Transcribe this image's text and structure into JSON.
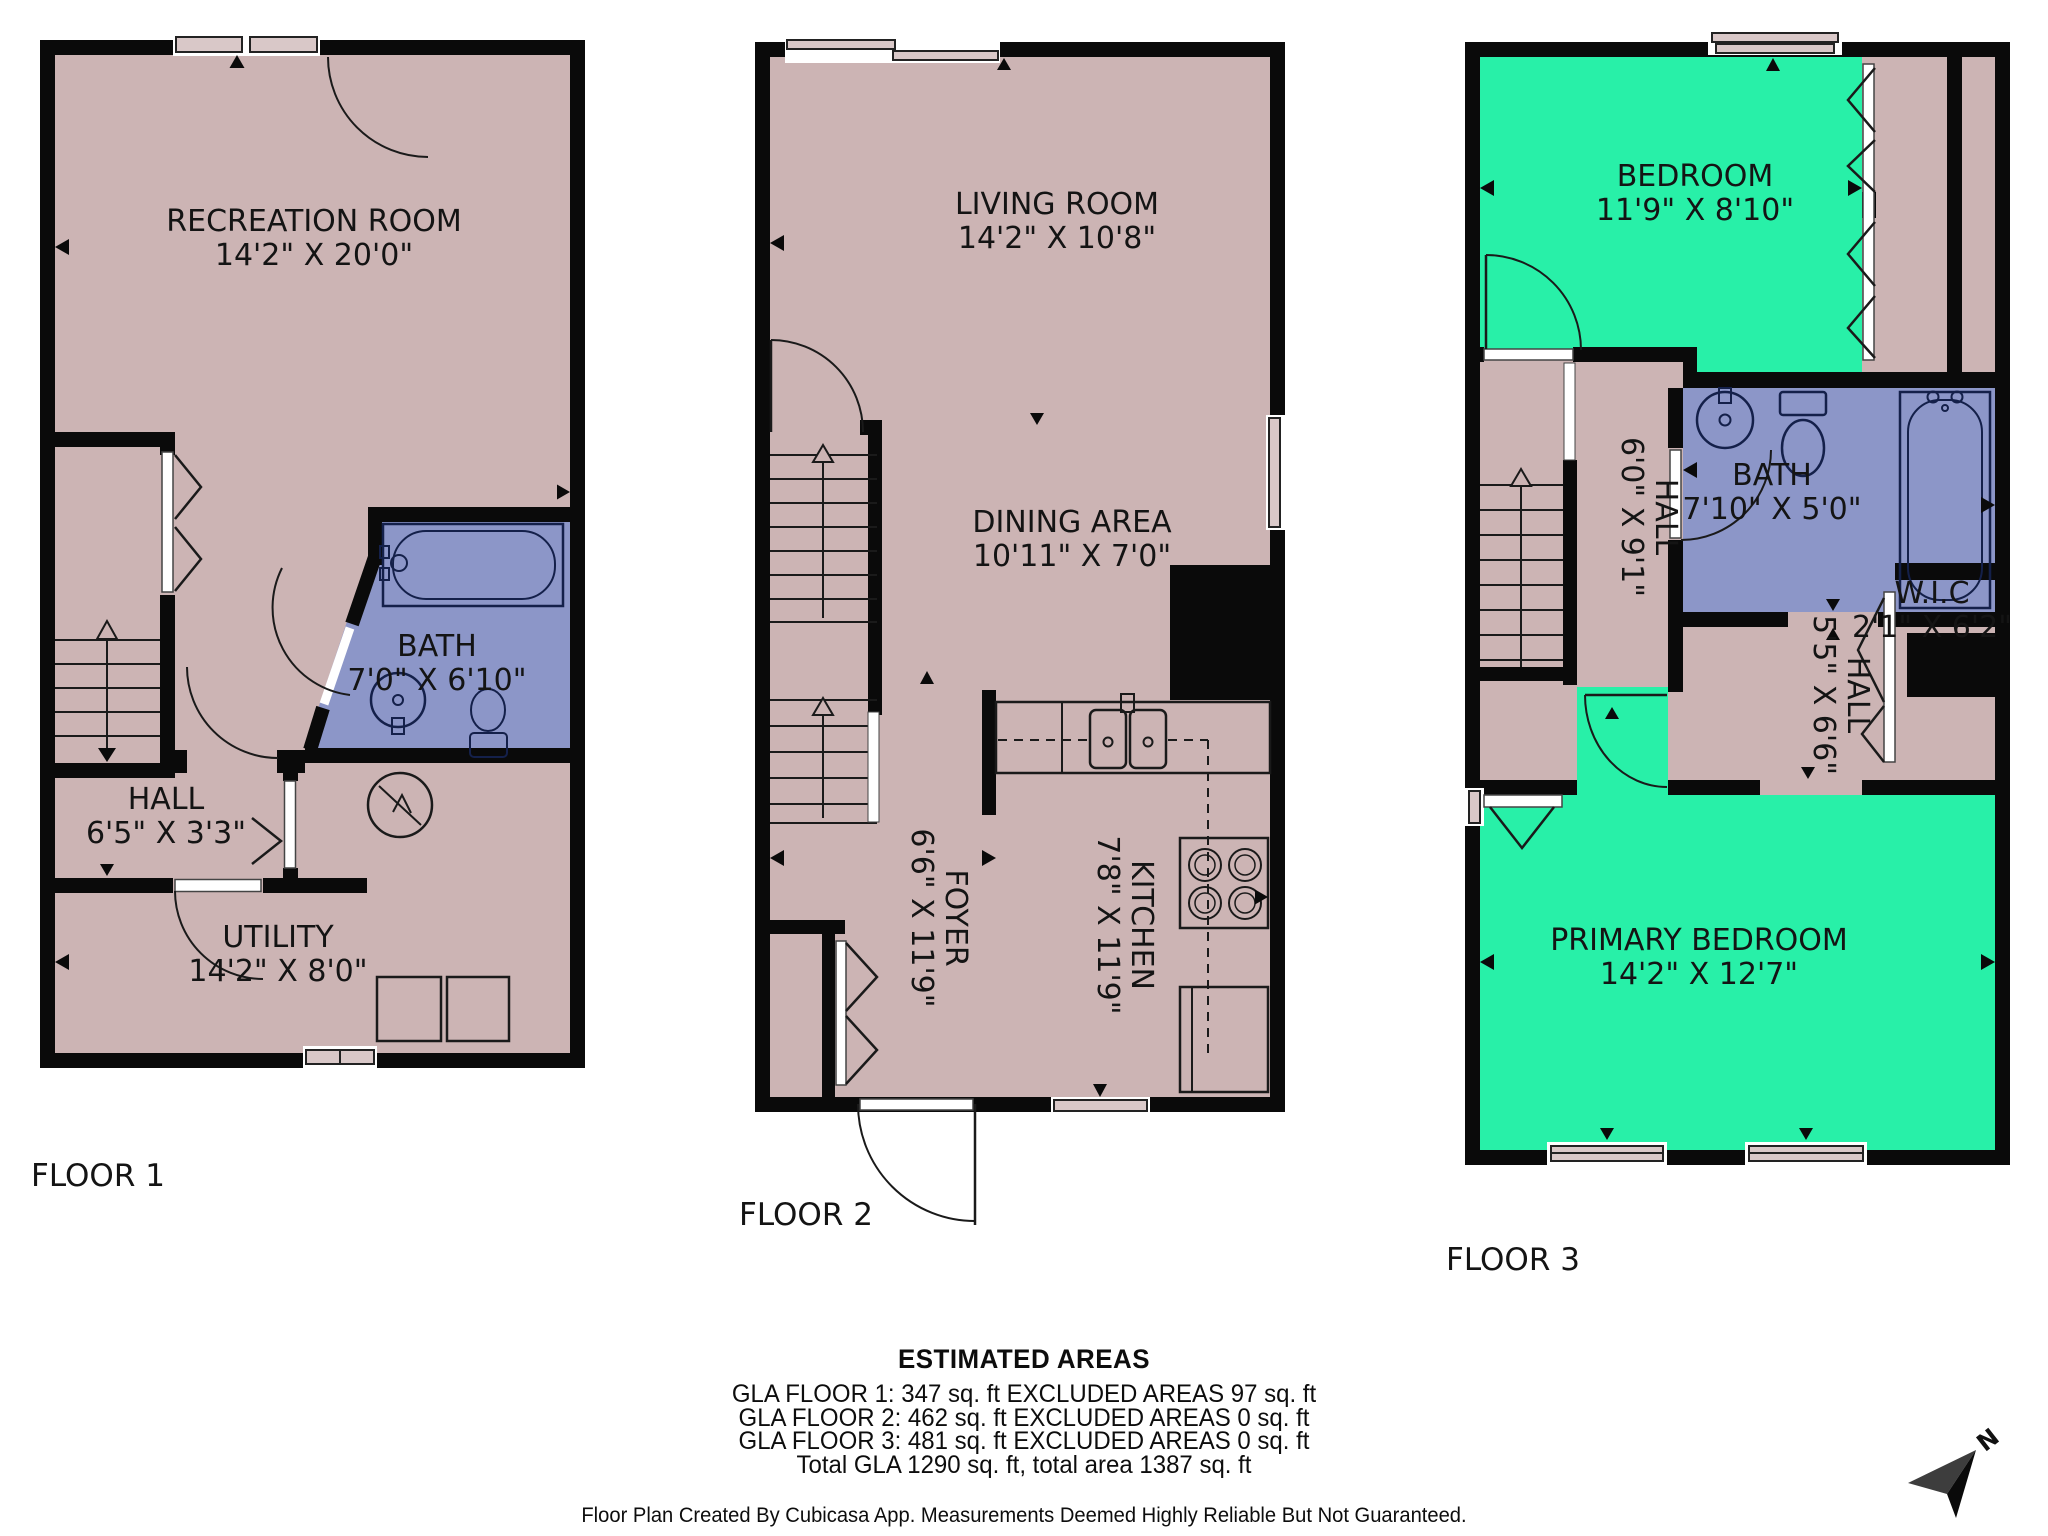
{
  "colors": {
    "floor": "#ccb4b4",
    "wet_room": "#8c96c8",
    "bedroom": "#28f0a8",
    "wall": "#0a0a0a",
    "background": "#ffffff"
  },
  "floors": [
    {
      "label": "FLOOR 1",
      "rooms": [
        {
          "name": "RECREATION ROOM",
          "dims": "14'2\" X 20'0\""
        },
        {
          "name": "BATH",
          "dims": "7'0\" X 6'10\""
        },
        {
          "name": "HALL",
          "dims": "6'5\" X 3'3\""
        },
        {
          "name": "UTILITY",
          "dims": "14'2\" X 8'0\""
        }
      ]
    },
    {
      "label": "FLOOR 2",
      "rooms": [
        {
          "name": "LIVING ROOM",
          "dims": "14'2\" X 10'8\""
        },
        {
          "name": "DINING AREA",
          "dims": "10'11\" X 7'0\""
        },
        {
          "name": "FOYER",
          "dims": "6'6\" X 11'9\""
        },
        {
          "name": "KITCHEN",
          "dims": "7'8\" X 11'9\""
        }
      ]
    },
    {
      "label": "FLOOR 3",
      "rooms": [
        {
          "name": "BEDROOM",
          "dims": "11'9\" X 8'10\""
        },
        {
          "name": "BATH",
          "dims": "7'10\" X 5'0\""
        },
        {
          "name": "HALL",
          "dims": "6'0\" X 9'1\""
        },
        {
          "name": "W.I.C",
          "dims": "2'1\" X 6'2\""
        },
        {
          "name": "HALL",
          "dims": "5'5\" X 6'6\""
        },
        {
          "name": "PRIMARY BEDROOM",
          "dims": "14'2\" X 12'7\""
        }
      ]
    }
  ],
  "areas": {
    "title": "ESTIMATED AREAS",
    "lines": [
      "GLA FLOOR 1: 347 sq. ft EXCLUDED AREAS 97 sq. ft",
      "GLA FLOOR 2: 462 sq. ft EXCLUDED AREAS 0 sq. ft",
      "GLA FLOOR 3: 481 sq. ft EXCLUDED AREAS 0 sq. ft",
      "Total GLA 1290 sq. ft, total area 1387 sq. ft"
    ],
    "disclaimer": "Floor Plan Created By Cubicasa App. Measurements Deemed Highly Reliable But Not Guaranteed."
  },
  "compass": {
    "label": "N"
  }
}
